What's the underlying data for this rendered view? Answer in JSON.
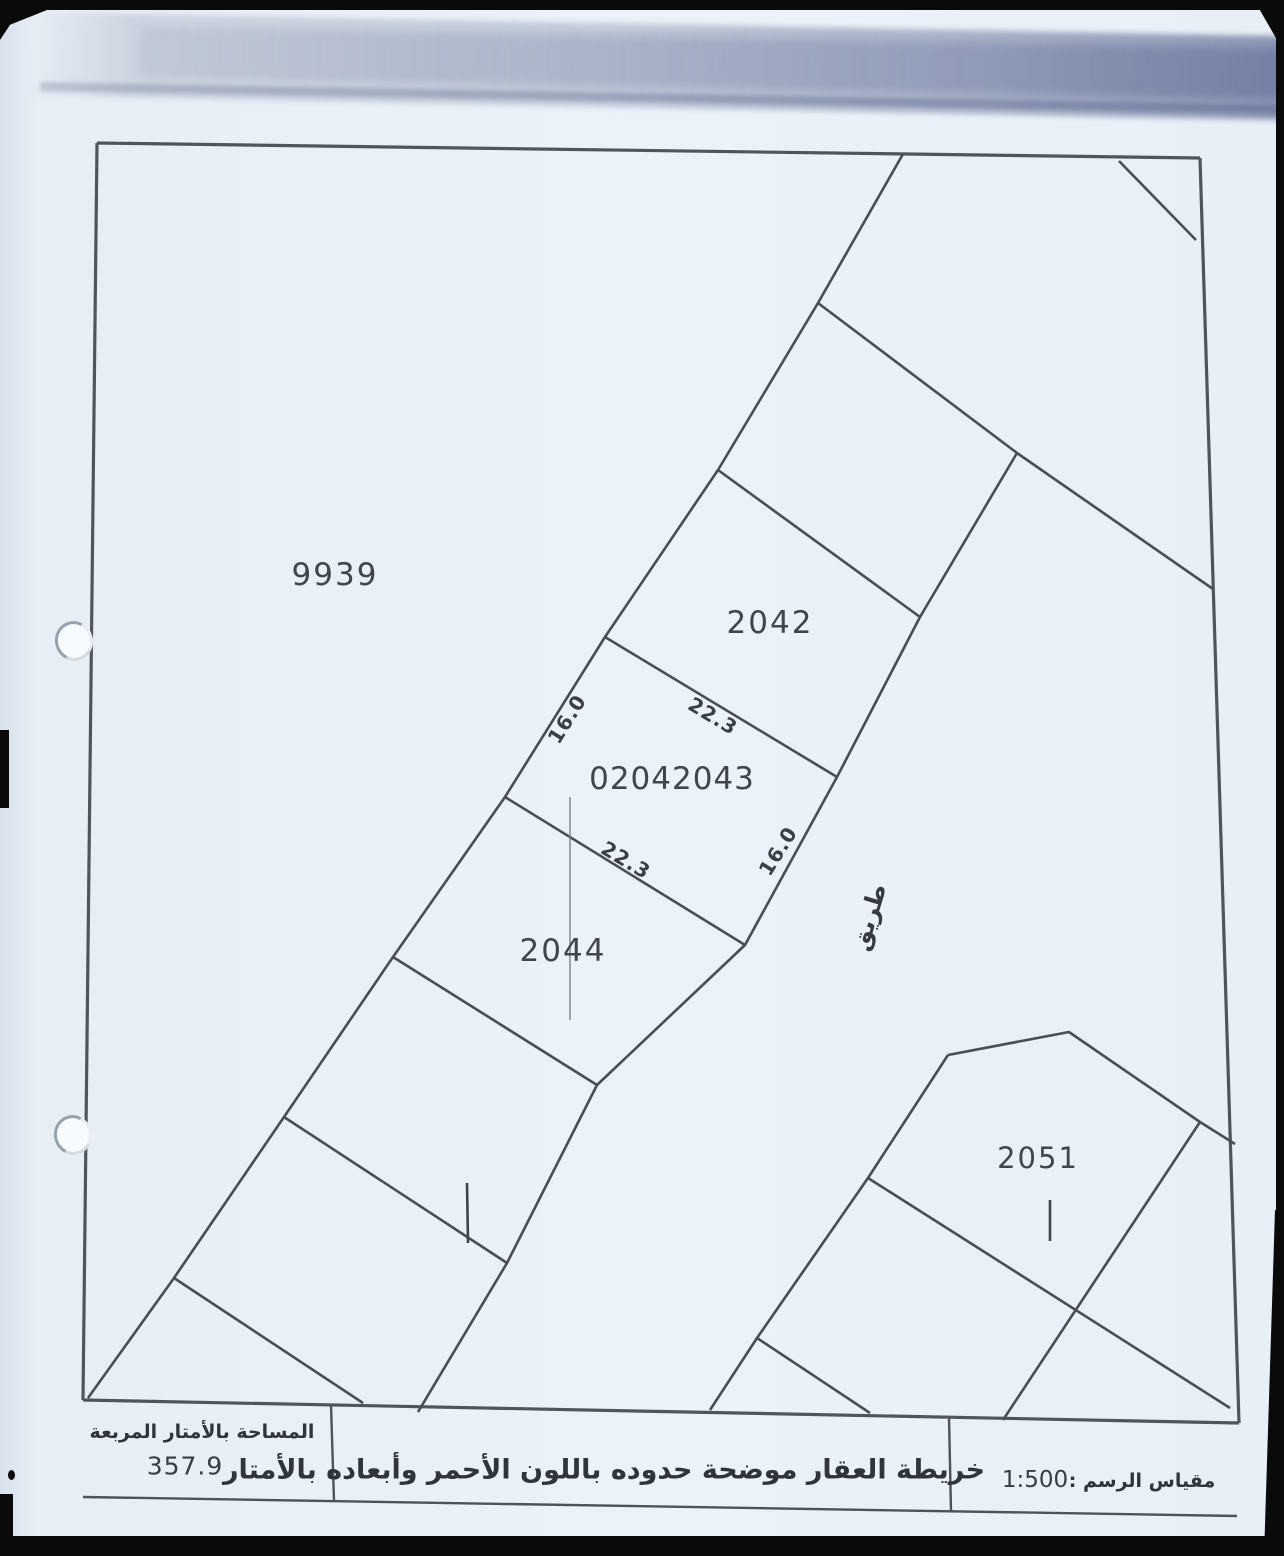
{
  "sheet": {
    "parcels": {
      "p9939": "9939",
      "p2042": "2042",
      "p2043": "02042043",
      "p2044": "2044",
      "p2051": "2051"
    },
    "dimensions": {
      "west": "16.0",
      "north": "22.3",
      "south": "22.3",
      "east": "16.0"
    },
    "road": "طريق",
    "table": {
      "area_header": "المساحة بالأمتار المربعة",
      "area_value": "357.9",
      "title": "خريطة العقار موضحة حدوده باللون الأحمر وأبعاده بالأمتار",
      "scale_label": "مقياس الرسم :",
      "scale_value": "1:500"
    },
    "colors": {
      "paper": "#e9f0f7",
      "ink": "#42464e"
    }
  }
}
